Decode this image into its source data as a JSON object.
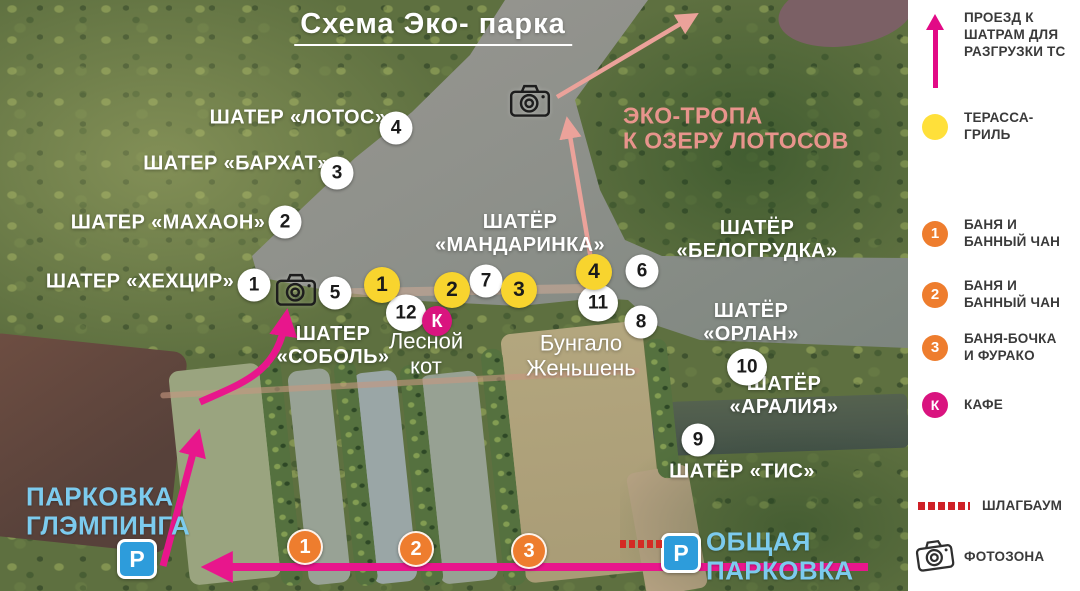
{
  "title": "Схема Эко- парка",
  "colors": {
    "route_magenta": "#e8168c",
    "eco_trail_salmon": "#eba29a",
    "terrace_yellow": "#f8d42e",
    "banya_orange": "#ee7d2e",
    "kafe_pink": "#d9147f",
    "parking_blue": "#2d9cdb",
    "parking_text_blue": "#7ccbee",
    "barrier_red": "#d42a24"
  },
  "map": {
    "labels": [
      {
        "text": "ШАТЕР «ЛОТОС»",
        "x": 298,
        "y": 118,
        "cls": "tent",
        "name": "label-tent-lotos"
      },
      {
        "text": "ШАТЕР «БАРХАТ»",
        "x": 236,
        "y": 164,
        "cls": "tent",
        "name": "label-tent-barkhat"
      },
      {
        "text": "ШАТЕР «МАХАОН»",
        "x": 168,
        "y": 223,
        "cls": "tent",
        "name": "label-tent-makhaon"
      },
      {
        "text": "ШАТЕР «ХЕХЦИР»",
        "x": 140,
        "y": 282,
        "cls": "tent",
        "name": "label-tent-khekhtsir"
      },
      {
        "text": "ШАТЁР\n«МАНДАРИНКА»",
        "x": 520,
        "y": 234,
        "cls": "tent",
        "name": "label-tent-mandarinka"
      },
      {
        "text": "ШАТЁР «БЕЛОГРУДКА»",
        "x": 757,
        "y": 240,
        "cls": "tent",
        "name": "label-tent-belogrudka"
      },
      {
        "text": "ШАТЕР\n«СОБОЛЬ»",
        "x": 333,
        "y": 346,
        "cls": "tent",
        "name": "label-tent-sobol"
      },
      {
        "text": "ШАТЁР «ОРЛАН»",
        "x": 751,
        "y": 323,
        "cls": "tent",
        "name": "label-tent-orlan"
      },
      {
        "text": "ШАТЁР «АРАЛИЯ»",
        "x": 784,
        "y": 396,
        "cls": "tent",
        "name": "label-tent-araliya"
      },
      {
        "text": "ШАТЁР «ТИС»",
        "x": 742,
        "y": 472,
        "cls": "tent",
        "name": "label-tent-tis"
      },
      {
        "text": "Лесной\nкот",
        "x": 426,
        "y": 354,
        "cls": "plain",
        "name": "label-lesnoy-kot"
      },
      {
        "text": "Бунгало\nЖеньшень",
        "x": 581,
        "y": 356,
        "cls": "plain",
        "name": "label-bungalo-zhenshen"
      },
      {
        "text": "ЭКО-ТРОПА\nК ОЗЕРУ ЛОТОСОВ",
        "x": 623,
        "y": 129,
        "cls": "eco left",
        "name": "label-eco-trail"
      },
      {
        "text": "ПАРКОВКА\nГЛЭМПИНГА",
        "x": 26,
        "y": 512,
        "cls": "parklbl left",
        "name": "label-glamping-parking"
      },
      {
        "text": "ОБЩАЯ\nПАРКОВКА",
        "x": 706,
        "y": 557,
        "cls": "parklbl left",
        "name": "label-general-parking"
      }
    ],
    "markers": [
      {
        "type": "white",
        "label": "1",
        "x": 254,
        "y": 285
      },
      {
        "type": "white",
        "label": "2",
        "x": 285,
        "y": 222
      },
      {
        "type": "white",
        "label": "3",
        "x": 337,
        "y": 173
      },
      {
        "type": "white",
        "label": "4",
        "x": 396,
        "y": 128
      },
      {
        "type": "white",
        "label": "5",
        "x": 335,
        "y": 293
      },
      {
        "type": "white",
        "label": "6",
        "x": 642,
        "y": 271
      },
      {
        "type": "white",
        "label": "7",
        "x": 486,
        "y": 281
      },
      {
        "type": "white",
        "label": "8",
        "x": 641,
        "y": 322
      },
      {
        "type": "white",
        "label": "9",
        "x": 698,
        "y": 440
      },
      {
        "type": "white",
        "label": "10",
        "x": 747,
        "y": 367
      },
      {
        "type": "white",
        "label": "11",
        "x": 598,
        "y": 303
      },
      {
        "type": "white",
        "label": "12",
        "x": 406,
        "y": 313
      },
      {
        "type": "yellow",
        "label": "1",
        "x": 382,
        "y": 285
      },
      {
        "type": "yellow",
        "label": "2",
        "x": 452,
        "y": 290
      },
      {
        "type": "yellow",
        "label": "3",
        "x": 519,
        "y": 290
      },
      {
        "type": "yellow",
        "label": "4",
        "x": 594,
        "y": 272
      },
      {
        "type": "orange",
        "label": "1",
        "x": 305,
        "y": 547
      },
      {
        "type": "orange",
        "label": "2",
        "x": 416,
        "y": 549
      },
      {
        "type": "orange",
        "label": "3",
        "x": 529,
        "y": 551
      },
      {
        "type": "kafe",
        "label": "К",
        "x": 437,
        "y": 321
      },
      {
        "type": "camera",
        "label": "",
        "x": 296,
        "y": 289
      },
      {
        "type": "camera",
        "label": "",
        "x": 530,
        "y": 100
      },
      {
        "type": "parking",
        "label": "P",
        "x": 137,
        "y": 559
      },
      {
        "type": "parking",
        "label": "P",
        "x": 681,
        "y": 553
      },
      {
        "type": "barrier",
        "label": "",
        "x": 641,
        "y": 544
      }
    ]
  },
  "legend": {
    "items": [
      {
        "icon": "route-arrow",
        "label": "ПРОЕЗД К\nШАТРАМ ДЛЯ\nРАЗГРУЗКИ ТС",
        "top": 10
      },
      {
        "icon": "terrace",
        "label": "ТЕРАССА-\nГРИЛЬ",
        "top": 110
      },
      {
        "icon": "banya",
        "num": "1",
        "label": "БАНЯ И\nБАННЫЙ ЧАН",
        "top": 217
      },
      {
        "icon": "banya",
        "num": "2",
        "label": "БАНЯ И\nБАННЫЙ ЧАН",
        "top": 278
      },
      {
        "icon": "banya",
        "num": "3",
        "label": "БАНЯ-БОЧКА\nИ ФУРАКО",
        "top": 331
      },
      {
        "icon": "kafe",
        "num": "К",
        "label": "КАФЕ",
        "top": 392
      },
      {
        "icon": "barrier",
        "label": "ШЛАГБАУМ",
        "top": 498
      },
      {
        "icon": "camera",
        "label": "ФОТОЗОНА",
        "top": 538
      }
    ]
  }
}
